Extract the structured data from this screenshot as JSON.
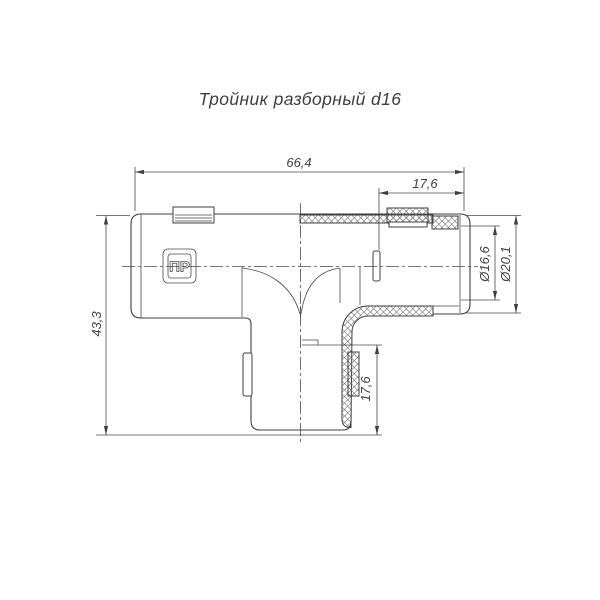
{
  "page": {
    "title": "Тройник разборный d16"
  },
  "drawing": {
    "logo_text": "ПР",
    "dimensions": {
      "total_length": "66,4",
      "top_socket_depth": "17,6",
      "total_height": "43,3",
      "inner_diameter": "Ø16,6",
      "outer_diameter": "Ø20,1",
      "bottom_socket_depth": "17,6"
    }
  },
  "colors": {
    "line": "#3f3f3f",
    "background": "#ffffff"
  }
}
